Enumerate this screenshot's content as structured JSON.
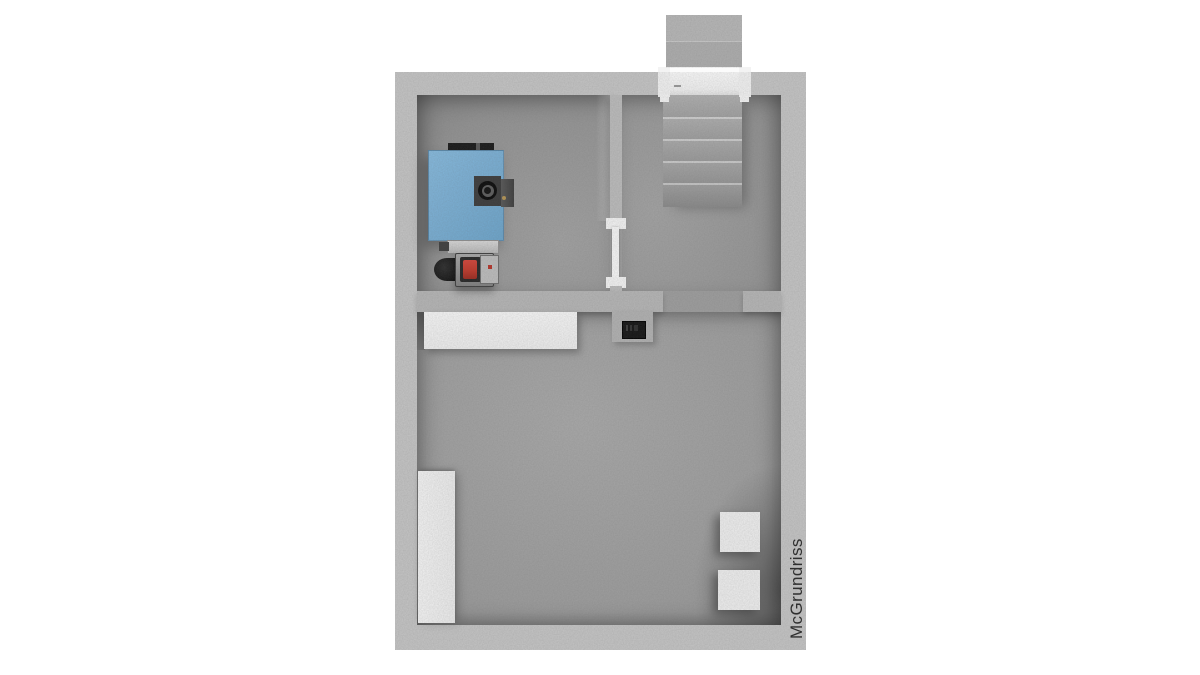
{
  "watermark": {
    "text": "McGrundriss",
    "color": "#2f2f2f"
  },
  "palette": {
    "background": "#ffffff",
    "outer_wall": "#c5c5c5",
    "inner_wall": "#b6b6b6",
    "floor_light": "#a9a9a9",
    "floor_shadow": "#7b7b7b",
    "furniture_white": "#f2f2f2",
    "boiler_blue": "#7bb0d5",
    "burner_red": "#c0392b",
    "equipment_black": "#141414",
    "stair_tread": "#a2a2a2"
  },
  "plan": {
    "rooms": [
      {
        "name": "room-top-left-boiler"
      },
      {
        "name": "room-top-right-stair-hall"
      },
      {
        "name": "room-bottom-main"
      }
    ],
    "objects": {
      "exterior_steps": {
        "step_count": 2
      },
      "staircase": {
        "tread_count": 5
      },
      "entry_door": {
        "color": "#f5f5f5"
      },
      "interior_door": {
        "color": "#f7f7f7"
      },
      "boiler": {
        "body_color": "#7bb0d5",
        "flue_color": "#3c3c3c"
      },
      "burner": {
        "window_color": "#c0392b",
        "motor_color": "#141414"
      },
      "electrical_panel": {
        "color": "#141414"
      },
      "counter": {
        "color": "#f2f2f2"
      },
      "tall_cabinet": {
        "color": "#f1f1f1"
      },
      "storage_boxes": {
        "count": 2,
        "color": "#efefef"
      }
    }
  }
}
